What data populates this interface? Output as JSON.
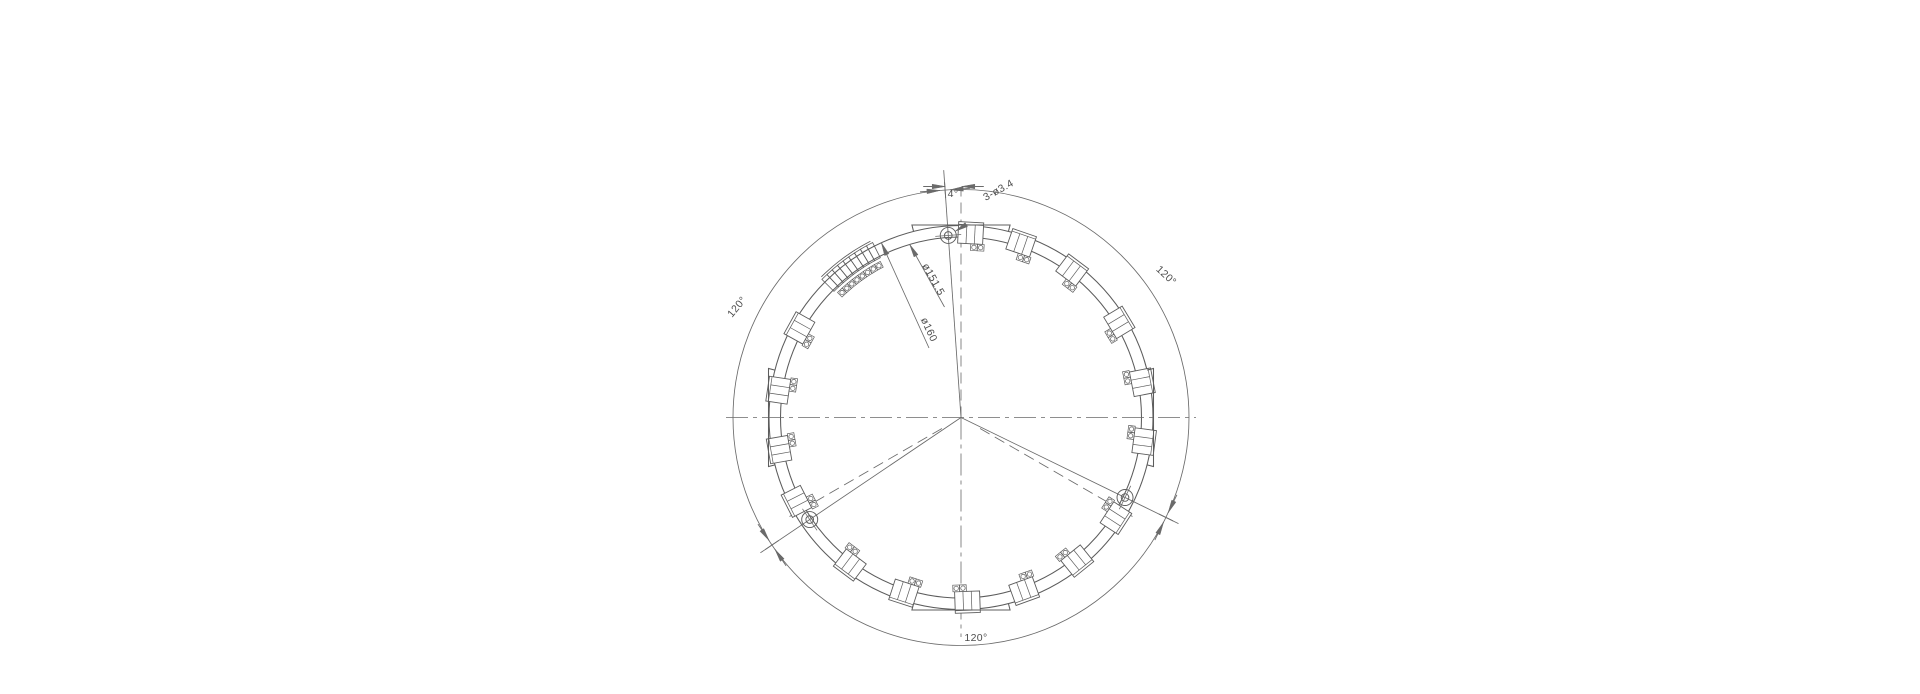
{
  "drawing": {
    "description": "circular-flange-engineering-drawing",
    "background": "#ffffff",
    "line_color": "#6a6a6a",
    "part_line_color": "#5c5c5c",
    "text_color": "#4d4d4d",
    "center": {
      "x": 961,
      "y": 417.5
    },
    "radii": {
      "dimension_circle": 228,
      "outer_circle": 192,
      "inner_circle": 180.5,
      "bolt_circle": 182.5,
      "hole_outer": 8,
      "hole_inner": 3.8
    },
    "flats": {
      "axes_deg": [
        0,
        90,
        180,
        270
      ],
      "half_angle_deg": 14.3,
      "tangent_radius": 192.5
    },
    "hole_axes_deg": [
      94,
      214,
      334
    ],
    "nominal_axes_deg": [
      210,
      330
    ],
    "blocks": [
      {
        "angle_deg": 87,
        "pad_end": -1
      },
      {
        "angle_deg": 71,
        "pad_end": -1
      },
      {
        "angle_deg": 53,
        "pad_end": -1
      },
      {
        "angle_deg": 31,
        "pad_end": -1
      },
      {
        "angle_deg": 11,
        "pad_end": 1
      },
      {
        "angle_deg": -7.5,
        "pad_end": 1
      },
      {
        "angle_deg": -33,
        "pad_end": 1
      },
      {
        "angle_deg": -51,
        "pad_end": -1
      },
      {
        "angle_deg": -70,
        "pad_end": 1
      },
      {
        "angle_deg": -88,
        "pad_end": -1
      },
      {
        "angle_deg": -108,
        "pad_end": 1
      },
      {
        "angle_deg": -127,
        "pad_end": -1
      },
      {
        "angle_deg": -153,
        "pad_end": 1
      },
      {
        "angle_deg": -170,
        "pad_end": -1
      },
      {
        "angle_deg": 151,
        "pad_end": 1
      },
      {
        "angle_deg": 171.5,
        "pad_end": -1
      }
    ],
    "strip": {
      "center_deg": 126,
      "span_deg": 18.4,
      "cells": 9,
      "pad_circles": 8,
      "outer_r": 196,
      "inner_r": 179,
      "edge_r": 198.2,
      "pad_r": 172.5
    },
    "annotations": {
      "angle_offset": {
        "label": "4°",
        "x": 953,
        "y": 197,
        "rot": 0,
        "size": 10.5
      },
      "holes_callout": {
        "label": "3-ø3.4",
        "x": 1000,
        "y": 193,
        "rot": -29,
        "size": 10.5,
        "leader_end": [
          1034,
          184
        ]
      },
      "inner_dia": {
        "label": "ø151.5",
        "x": 930.5,
        "y": 281,
        "rot": 61,
        "size": 10.5,
        "tip": [
          909.7,
          244.4
        ],
        "end": [
          944.5,
          307
        ]
      },
      "outer_dia": {
        "label": "ø160",
        "x": 926,
        "y": 331,
        "rot": 65,
        "size": 10.5,
        "tip": [
          881.4,
          242.8
        ],
        "end": [
          929,
          348
        ]
      },
      "angle_120_upper_left": {
        "label": "120°",
        "x": 739.5,
        "y": 309,
        "rot": -50,
        "size": 10.5
      },
      "angle_120_upper_right": {
        "label": "120°",
        "x": 1164,
        "y": 278,
        "rot": 43,
        "size": 10.5
      },
      "angle_120_bottom": {
        "label": "120°",
        "x": 976,
        "y": 641,
        "rot": 0,
        "size": 10.5
      }
    },
    "dim4": {
      "left_tip": [
        945.2,
        186.5
      ],
      "right_tip": [
        961.8,
        186.5
      ],
      "arrow_len": 15
    },
    "extents": {
      "h_centerline": [
        726,
        1196
      ],
      "v_centerline_bottom_y": 637,
      "v_nominal_top_y": 188,
      "hole_axis_top_r": 248,
      "hole_axis_lower_r": 242,
      "nominal_diag_r": 198
    }
  }
}
